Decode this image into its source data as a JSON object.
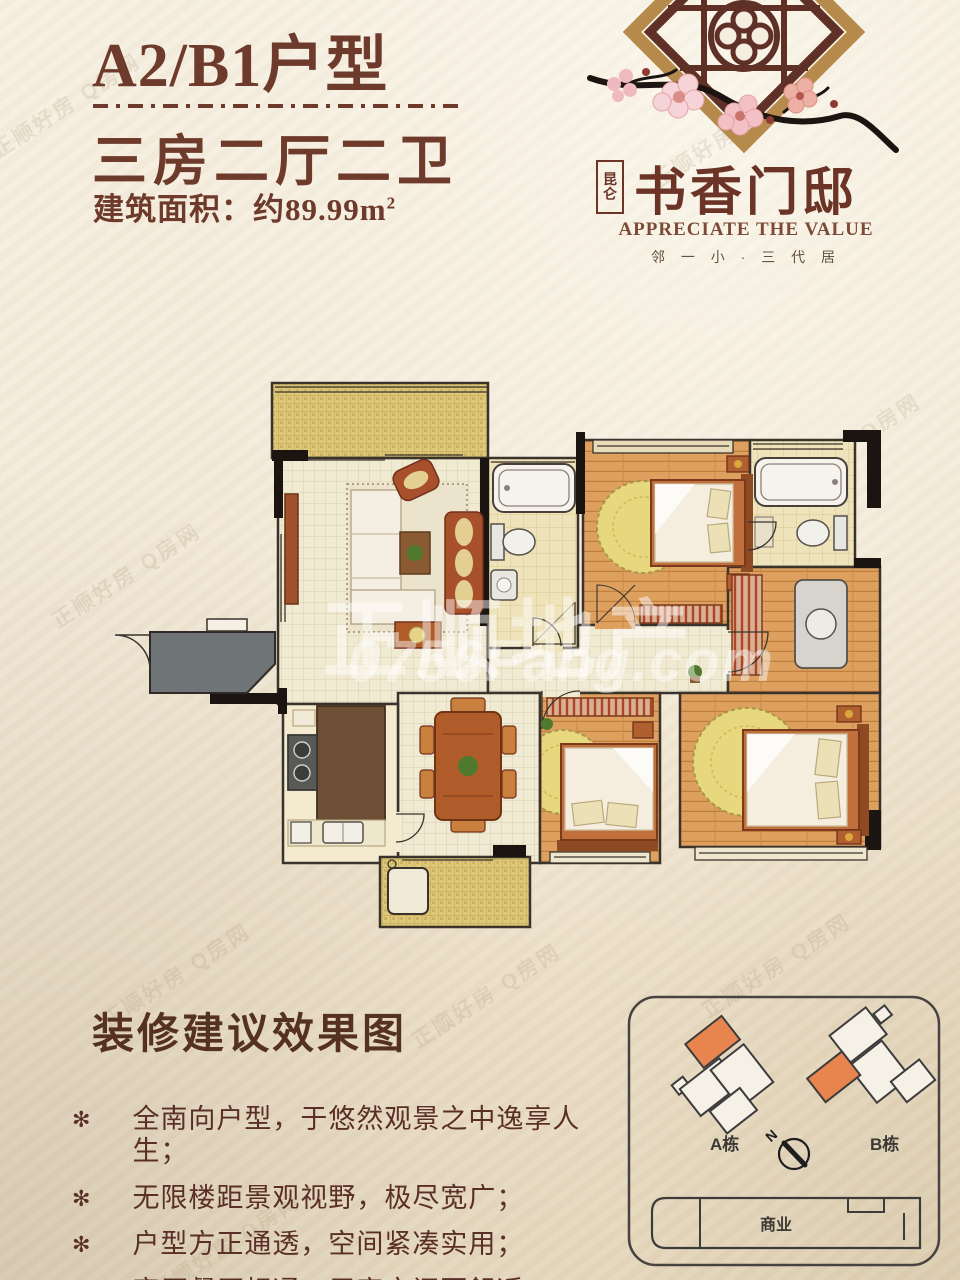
{
  "header": {
    "title": "A2/B1户型",
    "subtitle": "三房二厅二卫",
    "area_label": "建筑面积：约89.99m",
    "area_sup": "2"
  },
  "logo": {
    "brand_small_top": "昆",
    "brand_small_bottom": "仑",
    "brand": "书香门邸",
    "tagline_en": "APPRECIATE THE VALUE",
    "tagline_cn": "邻 一 小 · 三 代 居"
  },
  "watermarks": {
    "center_cn": "正顺地产",
    "center_url": "0756Fang.com",
    "diagonal": "正顺好房 Q房网"
  },
  "section": {
    "heading": "装修建议效果图",
    "bullet_glyph": "✻",
    "bullets": [
      "全南向户型，于悠然观景之中逸享人生；",
      "无限楼距景观视野，极尽宽广；",
      "户型方正通透，空间紧凑实用；",
      "客厅餐厅相通，居家空间更舒适。"
    ]
  },
  "siteplan": {
    "building_a_label": "A栋",
    "building_b_label": "B栋",
    "compass_n": "N",
    "commercial_label": "商业",
    "highlight_color": "#e8854f"
  },
  "colors": {
    "title_maroon": "#6e3a2b",
    "logo_maroon": "#5f3026",
    "frame_gold": "#b68a4a",
    "paper": "#f2e9d7",
    "wood_floor": "#dda05f",
    "mosaic_yellow": "#dcc878",
    "watermark_white": "rgba(255,255,255,0.48)"
  }
}
